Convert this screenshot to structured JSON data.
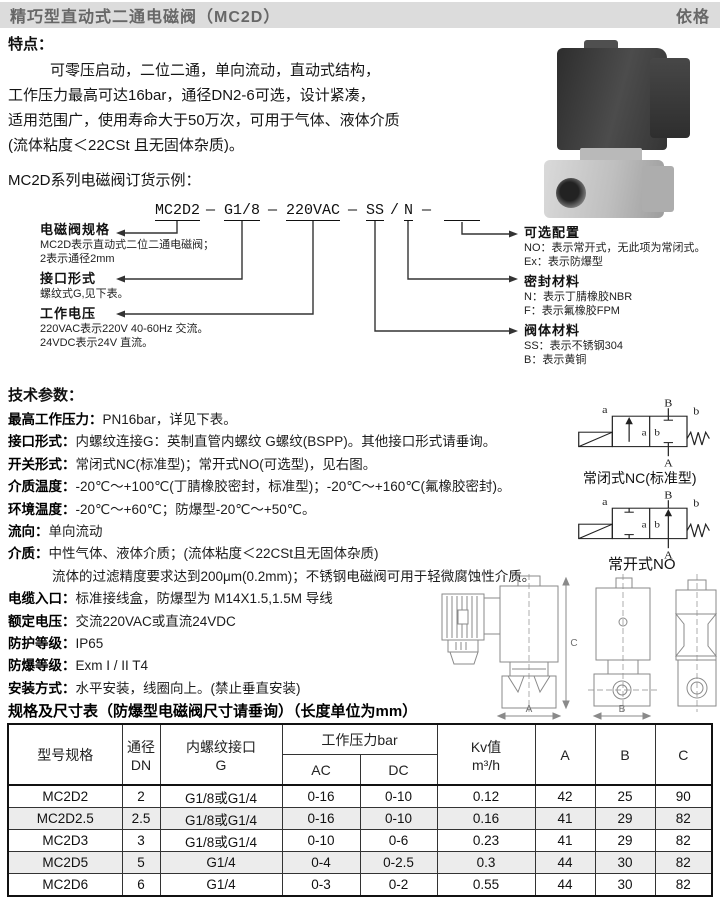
{
  "header": {
    "title": "精巧型直动式二通电磁阀（MC2D）",
    "brand": "依格"
  },
  "features": {
    "heading": "特点：",
    "lines": [
      "可零压启动，二位二通，单向流动，直动式结构，",
      "工作压力最高可达16bar，通径DN2-6可选，设计紧凑，",
      "适用范围广，使用寿命大于50万次，可用于气体、液体介质",
      "(流体粘度＜22CSt 且无固体杂质)。"
    ]
  },
  "ordering": {
    "heading": "MC2D系列电磁阀订货示例：",
    "code": {
      "model": "MC2D2",
      "sep1": "—",
      "port": "G1/8",
      "sep2": "—",
      "voltage": "220VAC",
      "sep3": "—",
      "body": "SS",
      "slash": "/",
      "seal": "N",
      "sep4": "—"
    },
    "left_labels": [
      {
        "title": "电磁阀规格",
        "desc": [
          "MC2D表示直动式二位二通电磁阀；",
          "2表示通径2mm"
        ]
      },
      {
        "title": "接口形式",
        "desc": [
          "螺纹式G,见下表。"
        ]
      },
      {
        "title": "工作电压",
        "desc": [
          "220VAC表示220V 40-60Hz 交流。",
          "24VDC表示24V 直流。"
        ]
      }
    ],
    "right_labels": [
      {
        "title": "可选配置",
        "desc": [
          "NO：表示常开式，无此项为常闭式。",
          "Ex：表示防爆型"
        ]
      },
      {
        "title": "密封材料",
        "desc": [
          "N：表示丁腈橡胶NBR",
          "F：表示氟橡胶FPM"
        ]
      },
      {
        "title": "阀体材料",
        "desc": [
          "SS：表示不锈钢304",
          "B：表示黄铜"
        ]
      }
    ]
  },
  "tech": {
    "heading": "技术参数：",
    "items": [
      {
        "label": "最高工作压力：",
        "text": "PN16bar，详见下表。"
      },
      {
        "label": "接口形式：",
        "text": "内螺纹连接G：英制直管内螺纹 G螺纹(BSPP)。其他接口形式请垂询。"
      },
      {
        "label": "开关形式：",
        "text": "常闭式NC(标准型)；常开式NO(可选型)，见右图。"
      },
      {
        "label": "介质温度：",
        "text": "-20℃～+100℃(丁腈橡胶密封，标准型)；-20℃～+160℃(氟橡胶密封)。"
      },
      {
        "label": "环境温度：",
        "text": "-20℃～+60℃；防爆型-20℃～+50℃。"
      },
      {
        "label": "流向：",
        "text": "单向流动"
      },
      {
        "label": "介质：",
        "text": "中性气体、液体介质；(流体粘度＜22CSt且无固体杂质)"
      },
      {
        "label": "",
        "text": "流体的过滤精度要求达到200μm(0.2mm)；不锈钢电磁阀可用于轻微腐蚀性介质。"
      },
      {
        "label": "电缆入口：",
        "text": "标准接线盒，防爆型为 M14X1.5,1.5M 导线"
      },
      {
        "label": "额定电压：",
        "text": "交流220VAC或直流24VDC"
      },
      {
        "label": "防护等级：",
        "text": "IP65"
      },
      {
        "label": "防爆等级：",
        "text": "Exm I / II T4"
      },
      {
        "label": "安装方式：",
        "text": "水平安装，线圈向上。(禁止垂直安装)"
      }
    ]
  },
  "symbols": {
    "nc_label": "常闭式NC(标准型)",
    "no_label": "常开式NO",
    "pos_a": "a",
    "pos_b": "b",
    "port_a": "A",
    "port_b": "B"
  },
  "drawing": {
    "dim_a": "A",
    "dim_b": "B",
    "dim_c": "C"
  },
  "table": {
    "title": "规格及尺寸表（防爆型电磁阀尺寸请垂询）（长度单位为mm）",
    "headers": {
      "model": "型号规格",
      "dn1": "通径",
      "dn2": "DN",
      "g1": "内螺纹接口",
      "g2": "G",
      "pressure": "工作压力bar",
      "ac": "AC",
      "dc": "DC",
      "kv1": "Kv值",
      "kv2": "m³/h",
      "a": "A",
      "b": "B",
      "c": "C"
    },
    "rows": [
      [
        "MC2D2",
        "2",
        "G1/8或G1/4",
        "0-16",
        "0-10",
        "0.12",
        "42",
        "25",
        "90"
      ],
      [
        "MC2D2.5",
        "2.5",
        "G1/8或G1/4",
        "0-16",
        "0-10",
        "0.16",
        "41",
        "29",
        "82"
      ],
      [
        "MC2D3",
        "3",
        "G1/8或G1/4",
        "0-10",
        "0-6",
        "0.23",
        "41",
        "29",
        "82"
      ],
      [
        "MC2D5",
        "5",
        "G1/4",
        "0-4",
        "0-2.5",
        "0.3",
        "44",
        "30",
        "82"
      ],
      [
        "MC2D6",
        "6",
        "G1/4",
        "0-3",
        "0-2",
        "0.55",
        "44",
        "30",
        "82"
      ]
    ]
  },
  "colors": {
    "header_bg": "#dcdcdc",
    "table_stripe": "#ececec",
    "line": "#222222"
  }
}
